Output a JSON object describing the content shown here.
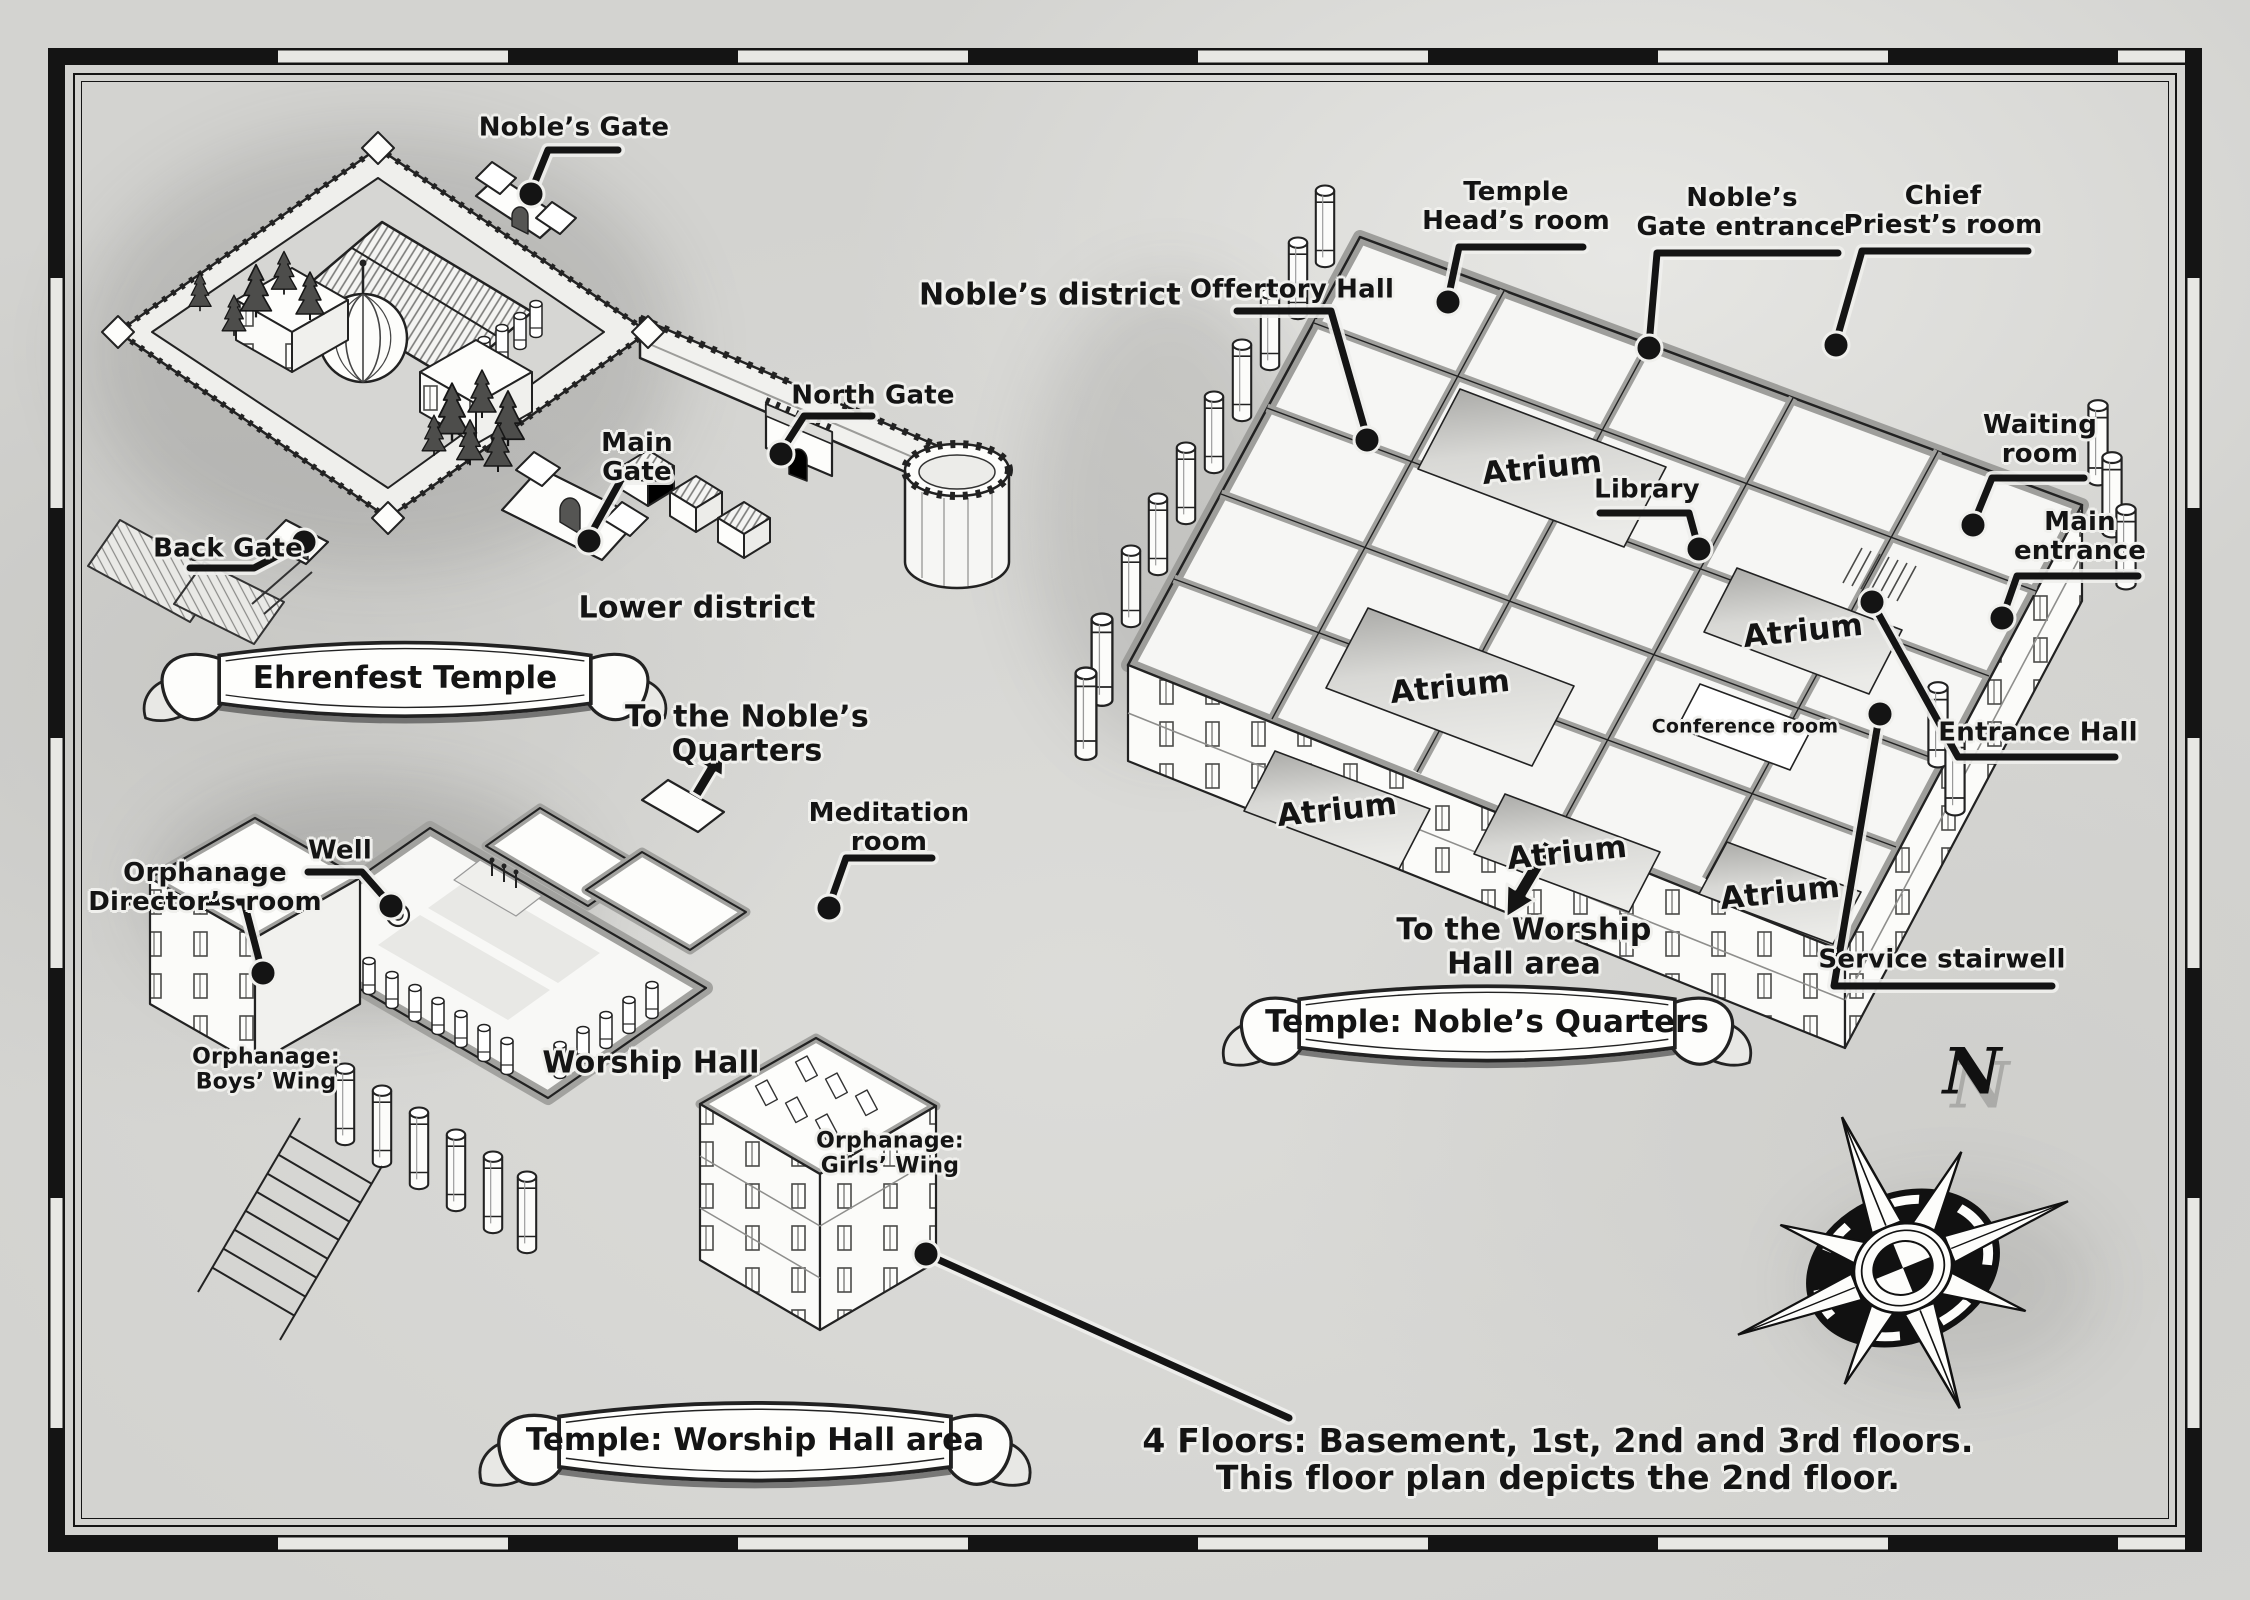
{
  "page": {
    "compass_north": "N",
    "footnote": {
      "line1": "4 Floors: Basement, 1st, 2nd and 3rd floors.",
      "line2": "This floor plan depicts the 2nd floor."
    }
  },
  "overview_map": {
    "banner": "Ehrenfest Temple",
    "districts": {
      "noble": "Noble’s district",
      "lower": "Lower district"
    },
    "callouts": {
      "nobles_gate": "Noble’s Gate",
      "north_gate": "North Gate",
      "main_gate": [
        "Main",
        "Gate"
      ],
      "back_gate": "Back Gate"
    }
  },
  "worship_map": {
    "banner": "Temple: Worship Hall area",
    "arrow_note": [
      "To the Noble’s",
      "Quarters"
    ],
    "callouts": {
      "meditation_room": [
        "Meditation",
        "room"
      ],
      "well": "Well",
      "orphanage_director": [
        "Orphanage",
        "Director’s room"
      ]
    },
    "rooms": {
      "worship_hall": "Worship Hall",
      "boys_wing": [
        "Orphanage:",
        "Boys’ Wing"
      ],
      "girls_wing": [
        "Orphanage:",
        "Girls’ Wing"
      ]
    }
  },
  "noble_map": {
    "banner": "Temple: Noble’s Quarters",
    "arrow_note": [
      "To the Worship",
      "Hall area"
    ],
    "callouts": {
      "offertory_hall": "Offertory Hall",
      "temple_head": [
        "Temple",
        "Head’s room"
      ],
      "gate_entrance": [
        "Noble’s",
        "Gate entrance"
      ],
      "chief_priest": [
        "Chief",
        "Priest’s room"
      ],
      "waiting_room": [
        "Waiting",
        "room"
      ],
      "main_entrance": [
        "Main",
        "entrance"
      ],
      "library": "Library",
      "entrance_hall": "Entrance Hall",
      "service_stairwell": "Service stairwell"
    },
    "rooms": {
      "atrium": "Atrium",
      "conference": "Conference room"
    }
  }
}
